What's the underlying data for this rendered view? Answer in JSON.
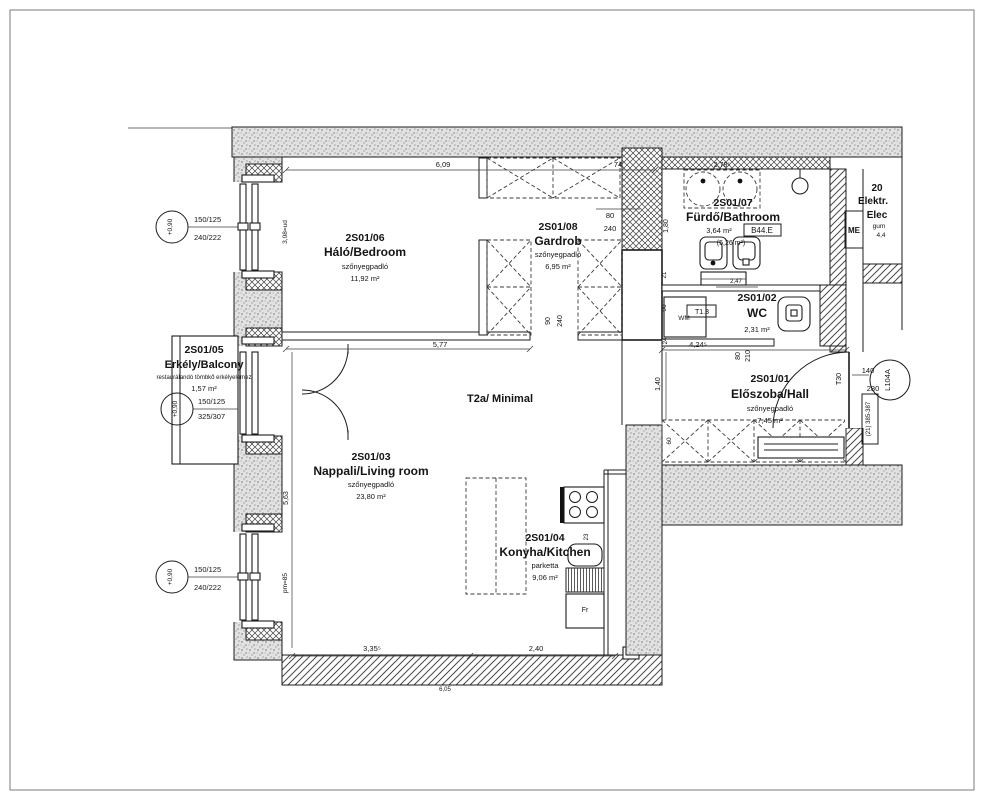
{
  "sheet": {
    "title": "T2a/ Minimal"
  },
  "rooms": {
    "bedroom": {
      "code": "2S01/06",
      "name": "Háló/Bedroom",
      "floor": "szőnyegpadló",
      "area": "11,92 m²"
    },
    "gardrob": {
      "code": "2S01/08",
      "name": "Gardrob",
      "floor": "szőnyegpadló",
      "area": "6,95 m²"
    },
    "bathroom": {
      "code": "2S01/07",
      "name": "Fürdő/Bathroom",
      "area": "3,64 m²",
      "area_gross": "(5,26 m²)",
      "finish_tag": "B44.E"
    },
    "wc": {
      "code": "2S01/02",
      "name": "WC",
      "area": "2,31 m²",
      "door_tag": "T1.3",
      "washer": "WM"
    },
    "hall": {
      "code": "2S01/01",
      "name": "Előszoba/Hall",
      "floor": "szőnyegpadló",
      "area": "7,45 m²"
    },
    "balcony": {
      "code": "2S01/05",
      "name": "Erkély/Balcony",
      "note": "restaurálandó tömbkő erkélyelemez",
      "area": "1,57 m²"
    },
    "living": {
      "code": "2S01/03",
      "name": "Nappali/Living room",
      "floor": "szőnyegpadló",
      "area": "23,80 m²"
    },
    "kitchen": {
      "code": "2S01/04",
      "name": "Konyha/Kitchen",
      "floor": "parketta",
      "area": "9,06 m²",
      "fridge": "Fr"
    },
    "electrical": {
      "l1": "20",
      "l2": "Elektr.",
      "l3": "Elec",
      "l4": "gum",
      "l5": "4,4",
      "shaft": "ME"
    }
  },
  "openings": {
    "window_bedroom": {
      "size": "150/125",
      "frame": "240/222",
      "sill": "+0,90",
      "note": "3,08=ud"
    },
    "balcony_door": {
      "size": "150/125",
      "frame": "325/307",
      "sill": "+0,90"
    },
    "window_living": {
      "size": "150/125",
      "frame": "240/222",
      "sill": "+0,90",
      "note": "pm=85"
    },
    "entry_door": {
      "tag": "T30",
      "w": "140",
      "h": "280",
      "ref": "L104A",
      "id_box": "(21) 385-387"
    },
    "bath_door": {
      "w": "80",
      "h": "240"
    },
    "wc_door": {
      "w": "80",
      "h": "210"
    },
    "gardrob_pass": {
      "w": "90",
      "h": "240"
    }
  },
  "dims": {
    "top": "6,09",
    "top_right": "74",
    "basin": "2,78⁵",
    "bath_h": "1,80",
    "bed_bottom": "5,77",
    "shelf": "2,47",
    "hall_top": "4,24⁵",
    "wall_a": "21",
    "wc_w": "90",
    "wall_b": "24",
    "pass_h": "1,40",
    "ward_h": "60",
    "living_h": "5,63",
    "bottom_left": "3,35⁵",
    "bottom_right": "2,40",
    "bottom_total": "6,05",
    "counter": "23"
  }
}
